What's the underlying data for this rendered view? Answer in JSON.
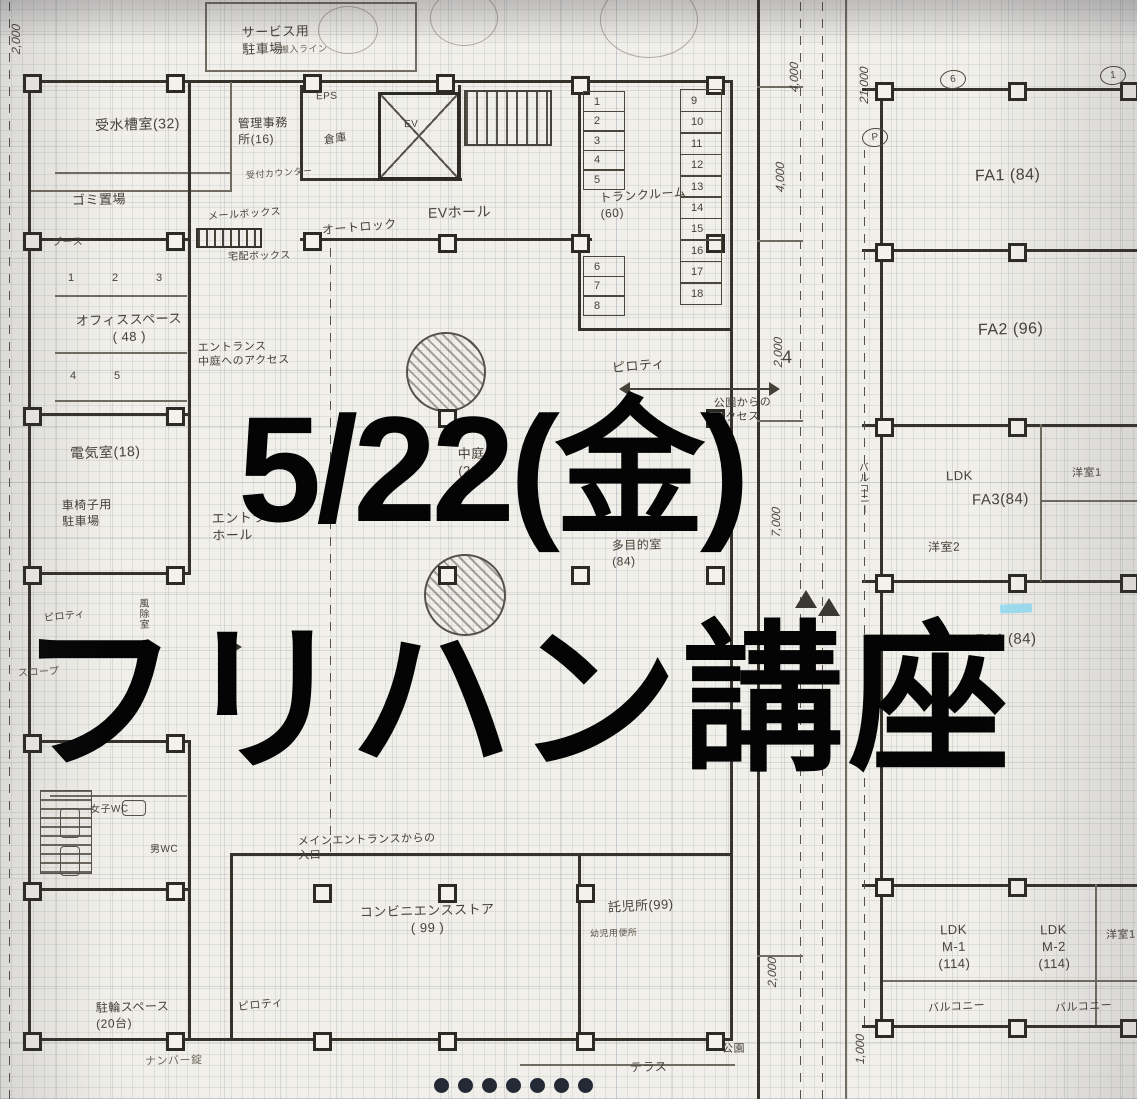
{
  "overlay": {
    "date": "5/22(金)",
    "title": "フリハン講座"
  },
  "plan": {
    "left": {
      "service_parking": "サービス用\n駐車場",
      "service_parking_sub": "搬入ライン",
      "water_tank_room": "受水槽室(32)",
      "manager_office": "管理事務\n所(16)",
      "garbage_area": "ゴミ置場",
      "eps": "EPS",
      "storage": "倉庫",
      "elevator": "EV",
      "ev_hall": "EVホール",
      "auto_lock": "オートロック",
      "mail_box": "メールボックス",
      "delivery_box": "宅配ボックス",
      "reception_counter": "受付カウンター",
      "booth": "ブース",
      "booth_numbers_row1": [
        "1",
        "2",
        "3"
      ],
      "booth_numbers_row2": [
        "4",
        "5"
      ],
      "office_space": "オフィススペース\n( 48 )",
      "entrance_access": "エントランス\n中庭へのアクセス",
      "electrical_room": "電気室(18)",
      "wheelchair_parking": "車椅子用\n駐車場",
      "entrance_hall": "エントランス\nホール",
      "trunk_room": "トランクルーム\n(60)",
      "trunk_lockers_a": [
        "1",
        "2",
        "3",
        "4",
        "5"
      ],
      "trunk_lockers_b": [
        "6",
        "7",
        "8"
      ],
      "trunk_lockers_c": [
        "9",
        "10",
        "11",
        "12",
        "13",
        "14",
        "15",
        "16",
        "17",
        "18"
      ],
      "piloti_center": "ピロティ",
      "park_access": "公園からの\nアクセス",
      "courtyard": "中庭\n(264)",
      "multipurpose_room": "多目的室\n(84)",
      "main_entrance_note": "メインエントランスからの\n入口",
      "convenience_store": "コンビニエンスストア\n( 99 )",
      "daycare": "託児所(99)",
      "toddler_wc": "幼児用便所",
      "womens_wc": "女子WC",
      "mens_wc": "男WC",
      "windbreak_room": "風除室",
      "piloti_left": "ピロティ",
      "slope": "スロープ",
      "bicycle_parking": "駐輪スペース\n(20台)",
      "number_lock": "ナンバー錠",
      "piloti_bottom": "ピロティ",
      "terrace": "テラス",
      "park": "公園"
    },
    "right": {
      "fa1": "FA1 (84)",
      "fa2": "FA2 (96)",
      "ldk": "LDK",
      "fa3": "FA3(84)",
      "bedroom1_top": "洋室1",
      "bedroom2": "洋室2",
      "fa4": "FA4 (84)",
      "balcony_side": "バルコニー",
      "ldk_m1": "LDK\nM-1\n(114)",
      "ldk_m2": "LDK\nM-2\n(114)",
      "bedroom1_bottom": "洋室1",
      "balcony_m1": "バルコニー",
      "balcony_m2": "バルコニー"
    },
    "dimensions": {
      "top_left": "2,000",
      "d1": "4,000",
      "d2": "4,000",
      "d3": "2,000",
      "d3_note": "4",
      "d4": "7,000",
      "d5": "21,000",
      "d6": "2,000",
      "d7": "1,000"
    },
    "grid_markers": [
      "6",
      "1",
      "P"
    ]
  },
  "footer": {
    "dots": [
      "",
      "",
      "",
      "",
      "",
      "",
      ""
    ]
  },
  "colors": {
    "ink": "#3f3c36",
    "overlay_text": "#000000",
    "highlight": "#8fdcf2",
    "paper": "#f1efe9",
    "dot": "#242a35"
  }
}
